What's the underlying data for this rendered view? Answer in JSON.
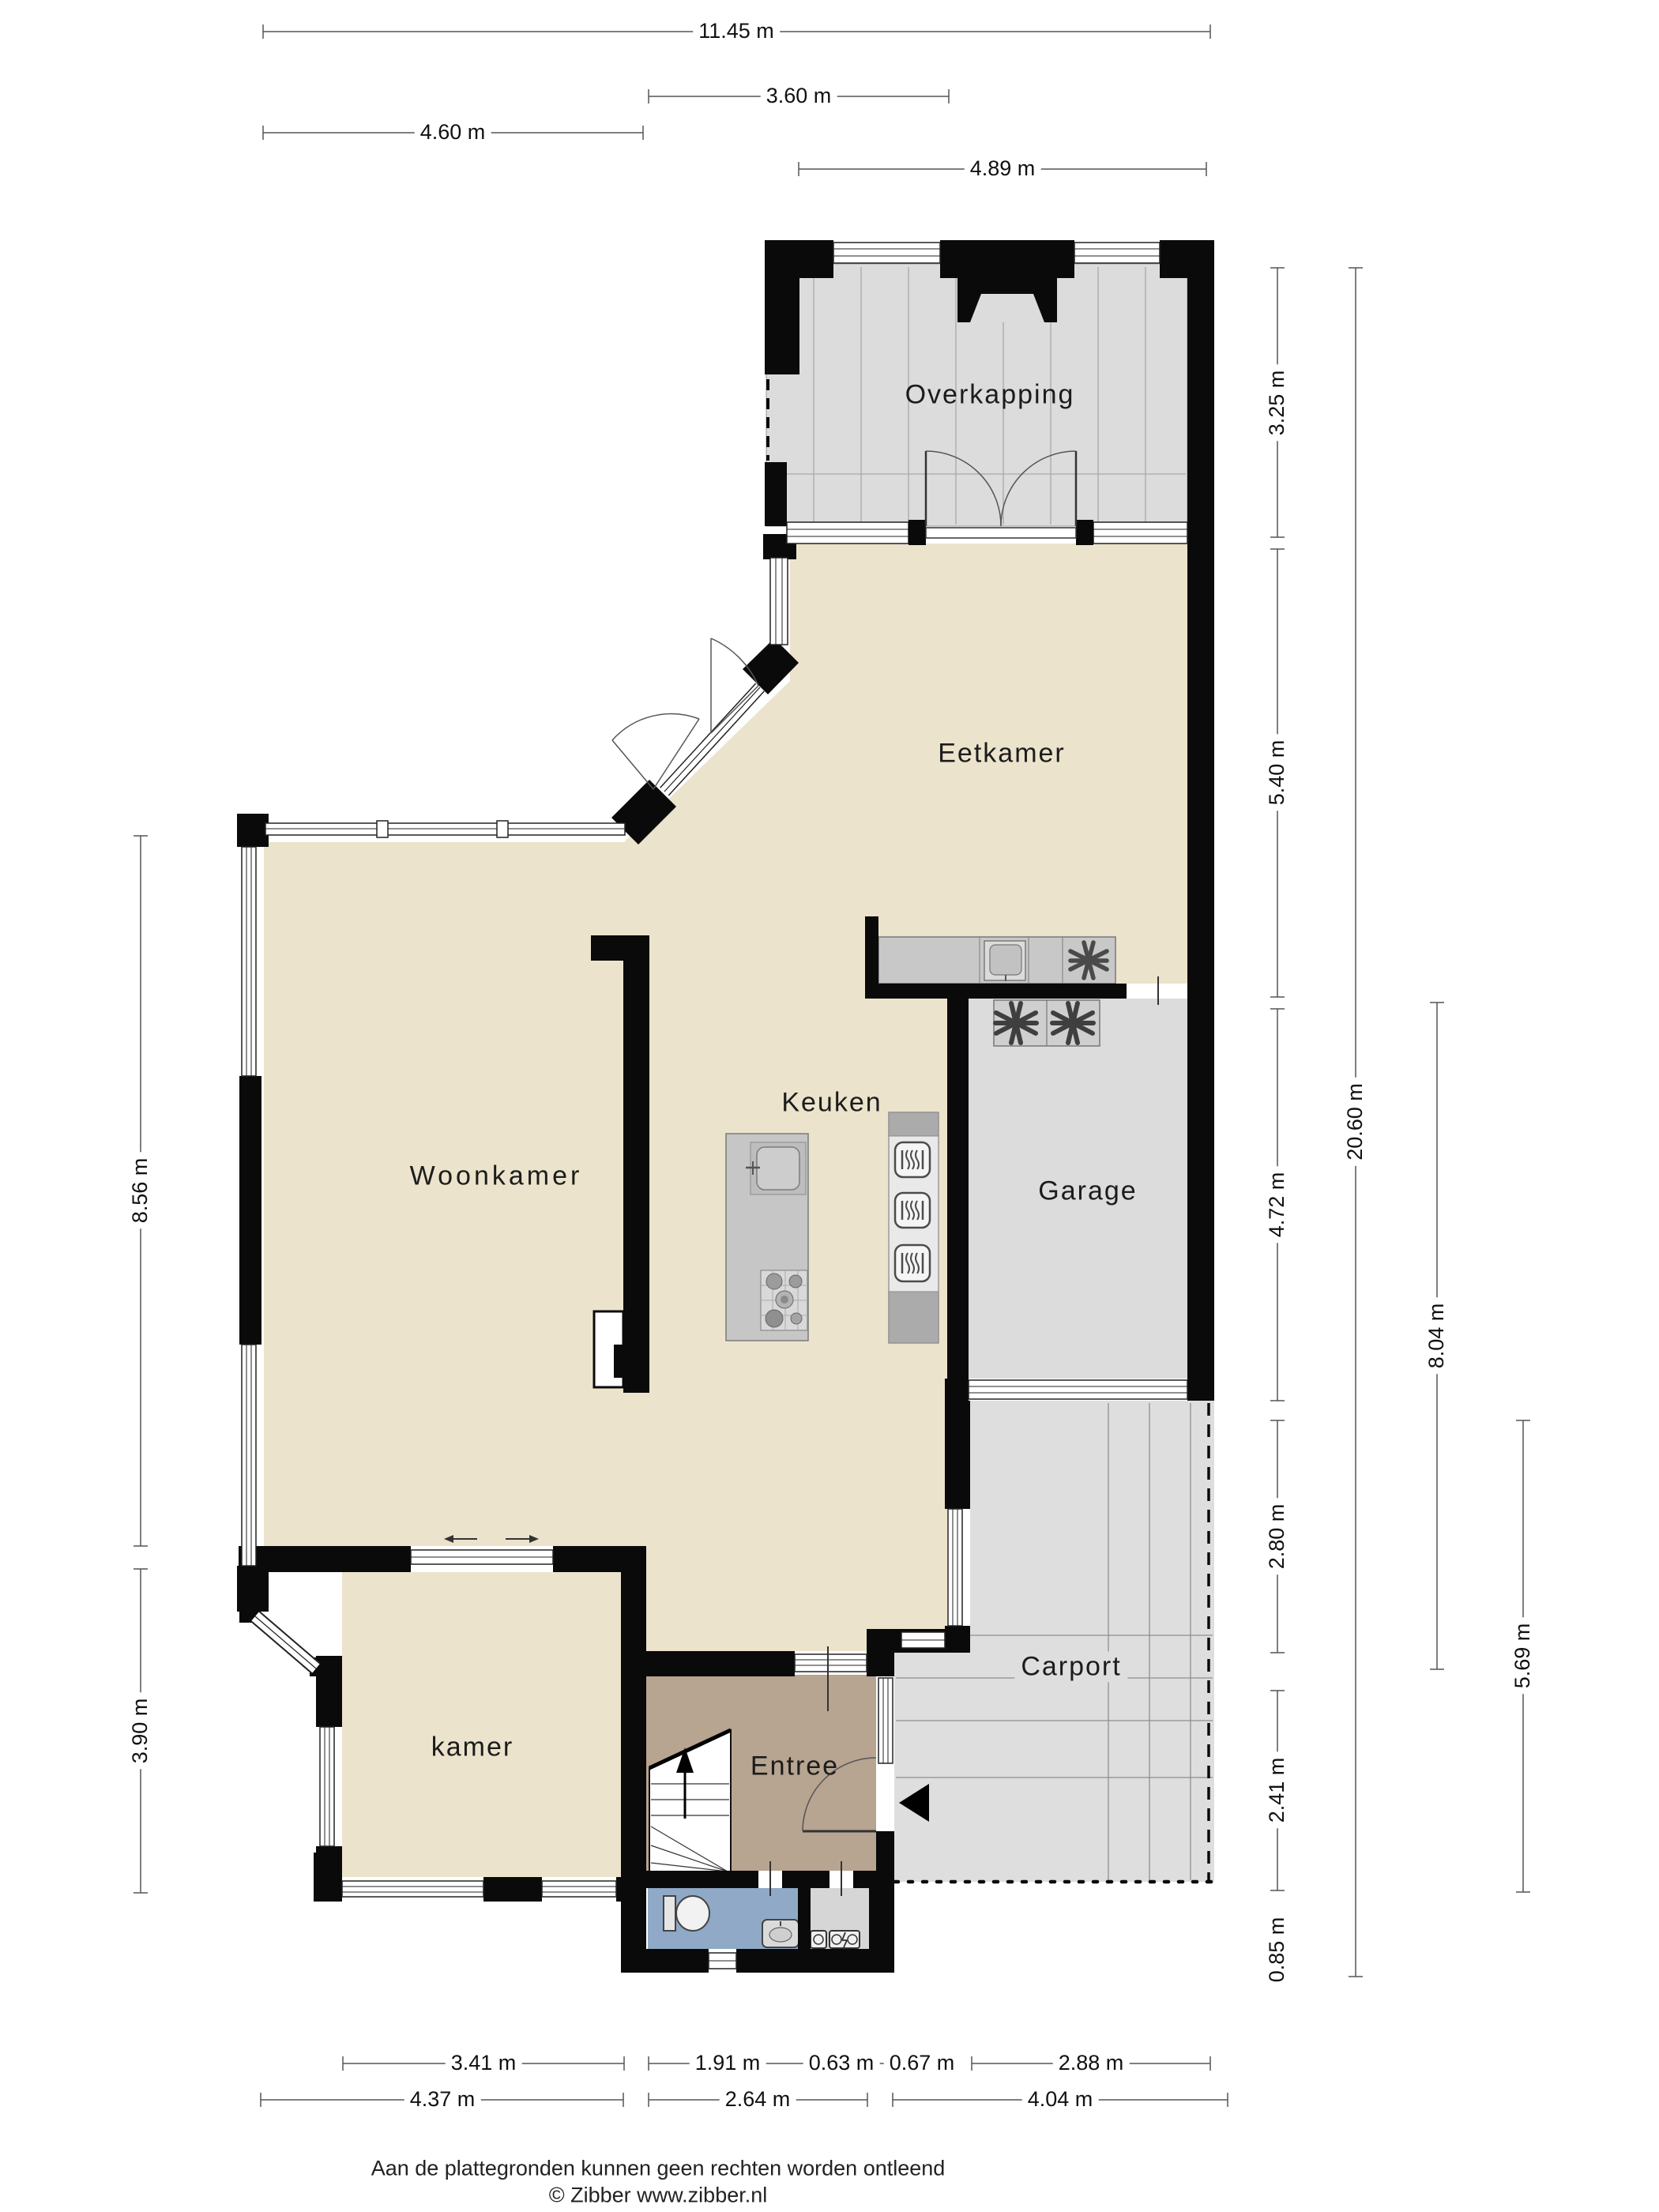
{
  "rooms": {
    "overkapping": "Overkapping",
    "eetkamer": "Eetkamer",
    "woonkamer": "Woonkamer",
    "keuken": "Keuken",
    "garage": "Garage",
    "carport": "Carport",
    "kamer": "kamer",
    "entree": "Entree"
  },
  "dimensions": {
    "top": [
      "11.45 m",
      "3.60 m",
      "4.60 m",
      "4.89 m"
    ],
    "left": [
      "8.56 m",
      "3.90 m"
    ],
    "right_inner": [
      "3.25 m",
      "5.40 m",
      "4.72 m",
      "2.80 m",
      "2.41 m",
      "0.85 m"
    ],
    "right_total": "20.60 m",
    "right_mid": "8.04 m",
    "right_outer": "5.69 m",
    "bottom_row1": [
      "3.41 m",
      "1.91 m",
      "0.63 m",
      "0.67 m",
      "2.88 m"
    ],
    "bottom_row2": [
      "4.37 m",
      "2.64 m",
      "4.04 m"
    ]
  },
  "footer": {
    "line1": "Aan de plattegronden kunnen geen rechten worden ontleend",
    "line2": "© Zibber www.zibber.nl"
  },
  "icons": {
    "hob": "six-spoke-asterisk",
    "washer": "six-petal-fan",
    "oven": "rounded-square-with-heat-squiggles",
    "entrance": "solid-left-triangle",
    "stairs": "winder-staircase-with-up-arrow"
  },
  "colors": {
    "floor_living": "#EBE3CC",
    "floor_outdoor": "#DCDCDC",
    "floor_entree": "#B7A491",
    "floor_toilet": "#8FA9C6",
    "floor_meter": "#D6D6D6",
    "wall": "#0A0A0A",
    "dimension_line": "#555555"
  }
}
